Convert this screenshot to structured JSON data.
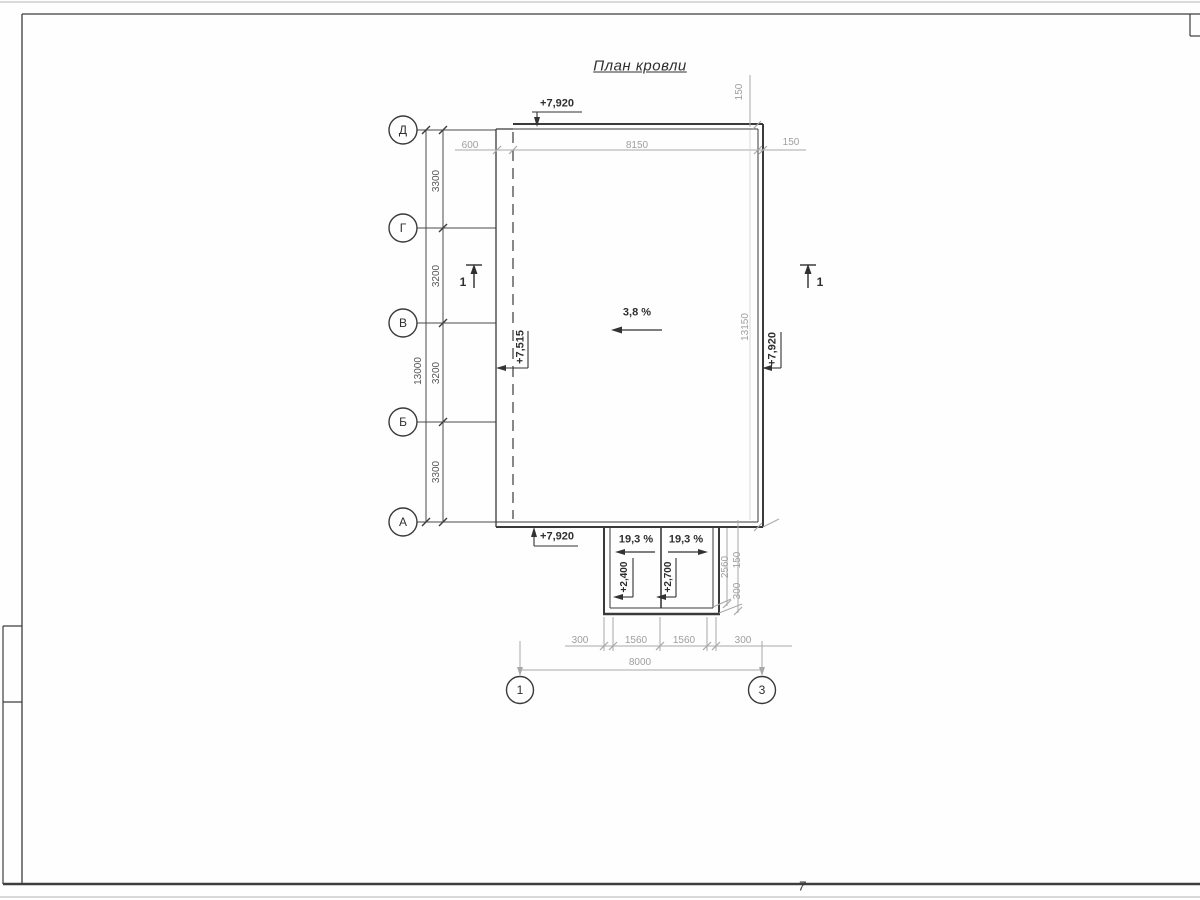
{
  "title": "План кровли",
  "page_number": "7",
  "colors": {
    "line_dark": "#3d3d3d",
    "dim_gray": "#9e9e9e",
    "light_gray": "#cfcfcf",
    "background": "#fefefe"
  },
  "axes": {
    "rows": [
      {
        "label": "Д"
      },
      {
        "label": "Г"
      },
      {
        "label": "В"
      },
      {
        "label": "Б"
      },
      {
        "label": "А"
      }
    ],
    "cols": [
      {
        "label": "1"
      },
      {
        "label": "3"
      }
    ]
  },
  "dimensions": {
    "left_segments": [
      "3300",
      "3200",
      "3200",
      "3300"
    ],
    "left_total": "13000",
    "top_segments": [
      "600",
      "8150",
      "150"
    ],
    "top_right_parapet": "150",
    "right_height": "13150",
    "canopy_right": [
      "2560",
      "150",
      "300"
    ],
    "bottom_segments": [
      "300",
      "1560",
      "1560",
      "300"
    ],
    "bottom_total": "8000"
  },
  "elevations": {
    "roof_top": "+7,920",
    "roof_left": "+7,515",
    "roof_right": "+7,920",
    "roof_bottom": "+7,920",
    "canopy_left": "+2,400",
    "canopy_right": "+2,700"
  },
  "slopes": {
    "main": "3,8 %",
    "canopy_left": "19,3 %",
    "canopy_right": "19,3 %"
  },
  "section_marks": {
    "left": "1",
    "right": "1"
  }
}
